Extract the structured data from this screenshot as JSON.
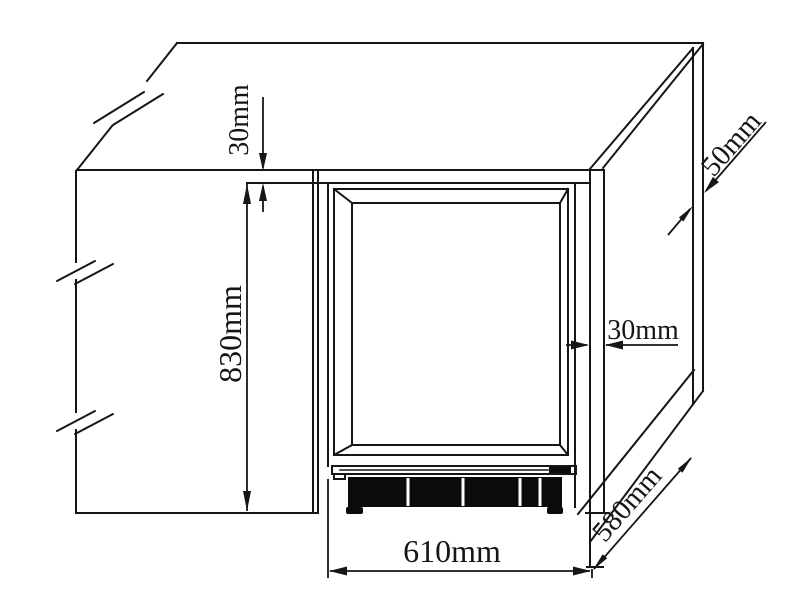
{
  "diagram": {
    "type": "technical-installation-drawing",
    "subject": "built-in appliance niche with clearance dimensions",
    "labels": {
      "top_gap": "30mm",
      "height": "830mm",
      "rear_gap": "50mm",
      "side_gap": "30mm",
      "width": "610mm",
      "depth": "580mm"
    },
    "colors": {
      "line": "#161616",
      "background": "#ffffff",
      "grille_fill": "#0b0b0b"
    }
  }
}
